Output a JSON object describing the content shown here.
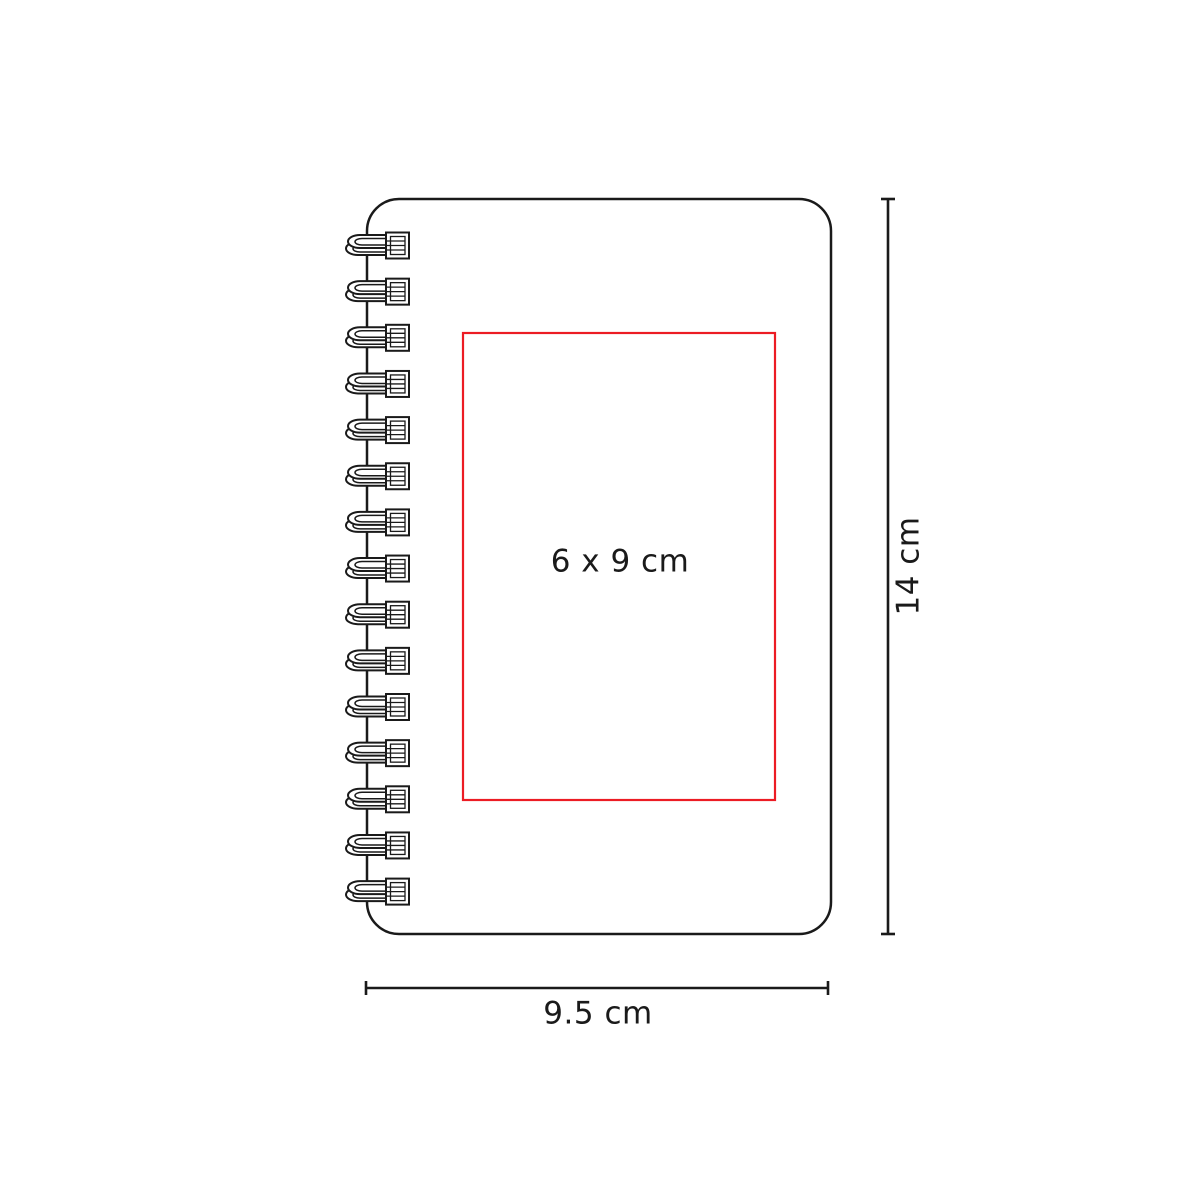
{
  "colors": {
    "accent": "#ec1c24",
    "line": "#1a1a1a",
    "background": "#ffffff"
  },
  "diagram": {
    "product": "spiral-notebook",
    "labels": {
      "imprint_area": "6 x 9 cm",
      "height": "14 cm",
      "width": "9.5 cm"
    },
    "spiral_ring_count": 15
  }
}
